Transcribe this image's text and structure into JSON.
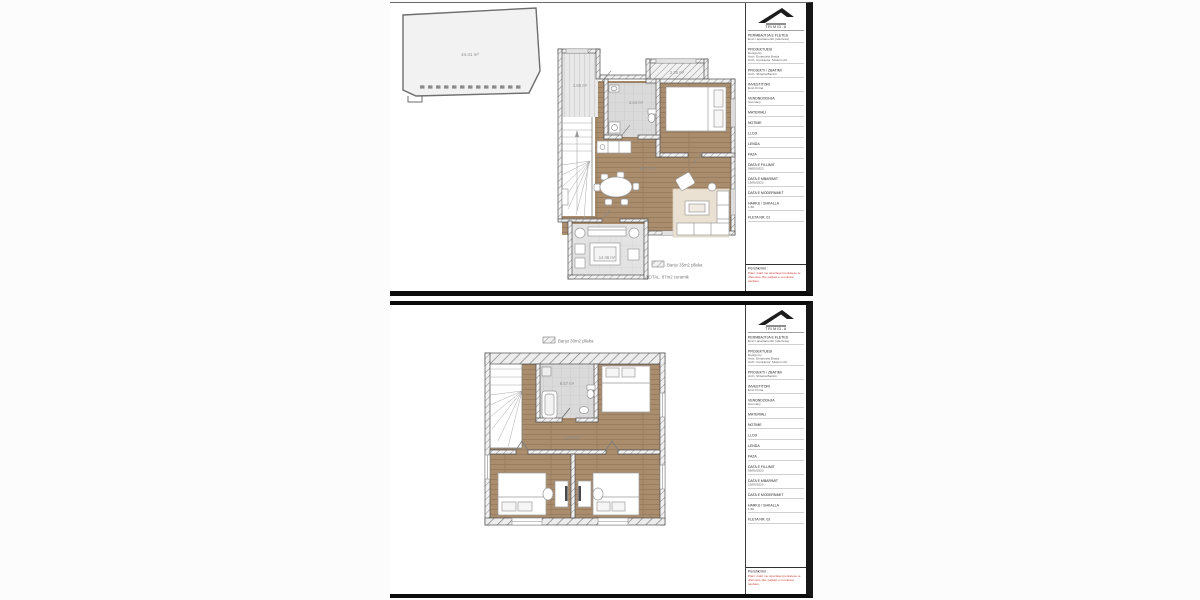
{
  "page": {
    "background": "#fcfcfc"
  },
  "colors": {
    "wood_floor": "#a98d6d",
    "tile_floor": "#dadada",
    "terrace_floor": "#e3e3e3",
    "sofa_rug": "#eae1d3",
    "wall_line": "#4f4f4f",
    "room_label": "#8c8c8c",
    "legend_text": "#777777",
    "description_red": "#ce4343",
    "sheet_border": "#0b0b0b"
  },
  "titleblock_shared": {
    "company": "TRIMID-A",
    "fields": [
      {
        "label": "PERMBAJTJA E FLETES",
        "sub": "Emri i apartamentit (ndertesa)"
      },
      {
        "label": "PROJEKTUESI",
        "sub": "Design by",
        "sub2": "Arch. Emanuela Brada",
        "sub3": "Arch. Contractor. Modern Art"
      },
      {
        "label": "PROJEKTI / ZBATIMI",
        "sub": "Arch. Shtepia Banimi"
      },
      {
        "label": "INVESTITORI",
        "sub": "Emri Firma"
      },
      {
        "label": "VENDNDODHJA",
        "sub": "Germany"
      },
      {
        "label": "MATERIALI"
      },
      {
        "label": "NOTIME"
      },
      {
        "label": "LLOJI"
      },
      {
        "label": "LENDA"
      },
      {
        "label": "FAZA"
      },
      {
        "label": "DATA E FILLIMIT",
        "sub": "08/05/2023"
      },
      {
        "label": "DATA E MBARIMIT",
        "sub": "15/05/2023"
      },
      {
        "label": "DATA E MODERNIMIT"
      },
      {
        "label": "HARKU / SHKALLA",
        "sub": "1:50"
      }
    ],
    "description_label": "Pershkrimi :",
    "description_text": "Plani i katit me siperfaqet perkatese te dhomave dhe pajisjet e montuara sanitare."
  },
  "sheets": [
    {
      "sheet_no": "FLETA NR. 01",
      "plan": {
        "roof_label": "44.41 m²",
        "balcony_left_label": "1.60 m²",
        "balcony_right_label": "2.30 m²",
        "bath_label": "3.44 m²",
        "living_label": "65.73 m²",
        "terrace_label": "14.46 m²",
        "legend_line1": "Banjo 35m2 pllaka",
        "legend_line2": "TOTAL: 87m2 ceramik"
      }
    },
    {
      "sheet_no": "FLETA NR. 02",
      "plan": {
        "legend_top": "Banjo 30m2 pllaka",
        "bath_label": "6.57 m²",
        "hall_label": "54.92 m²"
      }
    }
  ]
}
